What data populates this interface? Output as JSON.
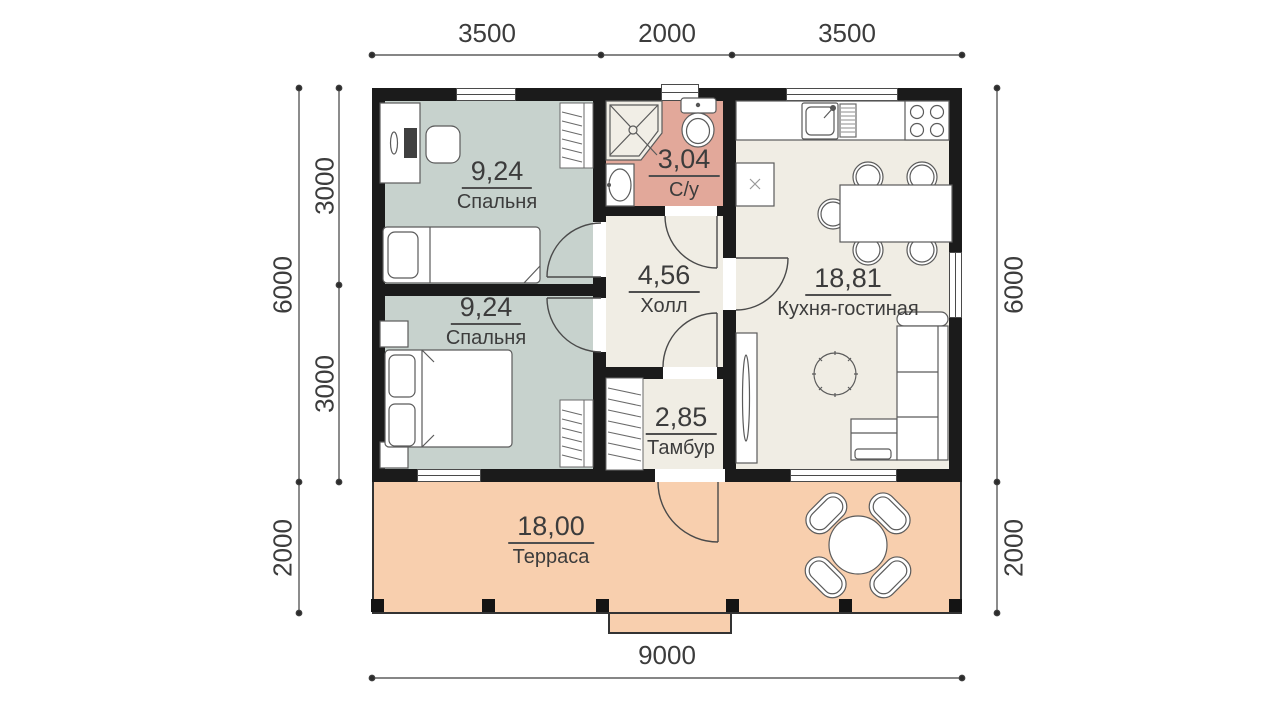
{
  "rooms": {
    "bedroom_top": {
      "area": "9,24",
      "name": "Спальня"
    },
    "bedroom_bottom": {
      "area": "9,24",
      "name": "Спальня"
    },
    "bathroom": {
      "area": "3,04",
      "name": "С/у"
    },
    "hall": {
      "area": "4,56",
      "name": "Холл"
    },
    "kitchen_living": {
      "area": "18,81",
      "name": "Кухня-гостиная"
    },
    "vestibule": {
      "area": "2,85",
      "name": "Тамбур"
    },
    "terrace": {
      "area": "18,00",
      "name": "Терраса"
    }
  },
  "dimensions": {
    "top_left": "3500",
    "top_center": "2000",
    "top_right": "3500",
    "bottom_total": "9000",
    "left_total": "6000",
    "left_upper": "3000",
    "left_lower": "3000",
    "left_terrace": "2000",
    "right_total": "6000",
    "right_terrace": "2000"
  },
  "colors": {
    "wall": "#1b1b1b",
    "bedroom_fill": "#c7d2cd",
    "bathroom_fill": "#e2a89a",
    "living_fill": "#f0ede4",
    "terrace_fill": "#f8cfae"
  }
}
